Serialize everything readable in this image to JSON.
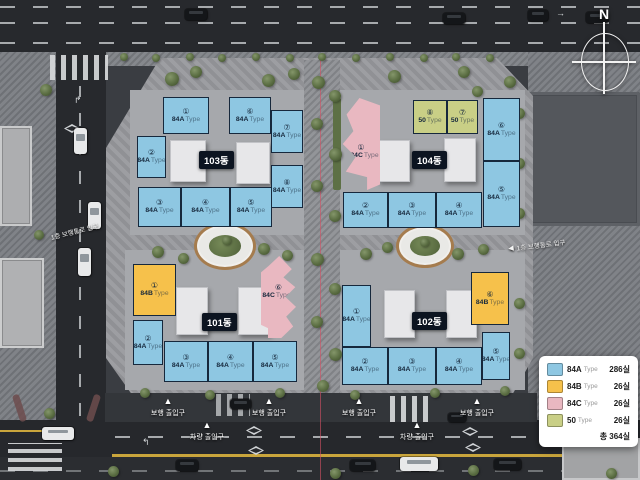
{
  "scene": {
    "compass": "N"
  },
  "labels": {
    "walkway_entrance": "1층 보행통로 입구",
    "pedestrian_entrance": "보행 출입구",
    "vehicle_entrance": "차량 출입구"
  },
  "unit_type_suffix": "Type",
  "type_colors": {
    "84A": "#8ec7e2",
    "84B": "#f6c14b",
    "84C": "#e9b8c1",
    "50": "#c9cf86"
  },
  "buildings": [
    {
      "name": "101동",
      "units": [
        {
          "no": "①",
          "type": "84B"
        },
        {
          "no": "②",
          "type": "84A"
        },
        {
          "no": "③",
          "type": "84A"
        },
        {
          "no": "④",
          "type": "84A"
        },
        {
          "no": "⑤",
          "type": "84A"
        },
        {
          "no": "⑥",
          "type": "84C"
        }
      ]
    },
    {
      "name": "102동",
      "units": [
        {
          "no": "①",
          "type": "84A"
        },
        {
          "no": "②",
          "type": "84A"
        },
        {
          "no": "③",
          "type": "84A"
        },
        {
          "no": "④",
          "type": "84A"
        },
        {
          "no": "⑤",
          "type": "84A"
        },
        {
          "no": "⑥",
          "type": "84B"
        }
      ]
    },
    {
      "name": "103동",
      "units": [
        {
          "no": "①",
          "type": "84A"
        },
        {
          "no": "②",
          "type": "84A"
        },
        {
          "no": "③",
          "type": "84A"
        },
        {
          "no": "④",
          "type": "84A"
        },
        {
          "no": "⑤",
          "type": "84A"
        },
        {
          "no": "⑥",
          "type": "84A"
        },
        {
          "no": "⑦",
          "type": "84A"
        },
        {
          "no": "⑧",
          "type": "84A"
        }
      ]
    },
    {
      "name": "104동",
      "units": [
        {
          "no": "①",
          "type": "84C"
        },
        {
          "no": "②",
          "type": "84A"
        },
        {
          "no": "③",
          "type": "84A"
        },
        {
          "no": "④",
          "type": "84A"
        },
        {
          "no": "⑤",
          "type": "84A"
        },
        {
          "no": "⑥",
          "type": "84A"
        },
        {
          "no": "⑦",
          "type": "50"
        },
        {
          "no": "⑧",
          "type": "50"
        }
      ]
    }
  ],
  "legend": {
    "items": [
      {
        "type": "84A",
        "suffix": "Type",
        "count": "286실"
      },
      {
        "type": "84B",
        "suffix": "Type",
        "count": "26실"
      },
      {
        "type": "84C",
        "suffix": "Type",
        "count": "26실"
      },
      {
        "type": "50",
        "suffix": "Type",
        "count": "26실"
      }
    ],
    "total": "총 364실"
  }
}
